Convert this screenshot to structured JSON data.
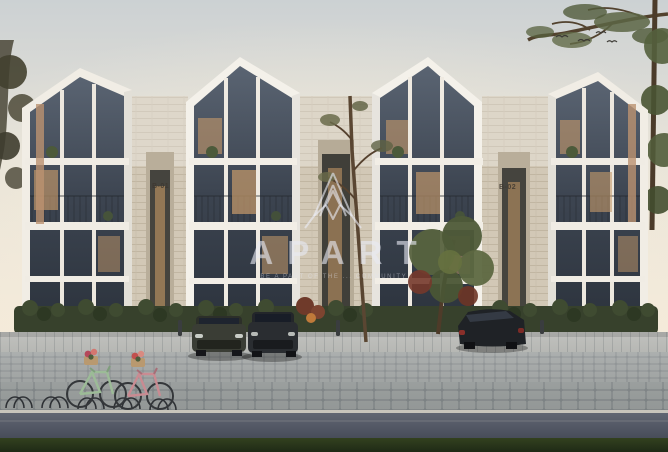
{
  "image": {
    "kind": "architectural-exterior-render",
    "description": "Dusk rendering of a modern residential complex: four white gabled glass-fronted townhouse units joined by stone-clad sections, hedges and trees in front, cobblestone plaza with parked SUVs and two bicycles with flower baskets, pine branch overhanging the sky at top right, semi-transparent APART watermark centered."
  },
  "watermark": {
    "brand": "APART",
    "tagline": "BE A PART OF THE ... COMMUNITY",
    "logo": "apart-pyramid-lattice-logo",
    "color": "rgba(230,233,243,0.55)"
  },
  "building": {
    "unit_labels": [
      "B-01",
      "B-02"
    ],
    "floors": 3,
    "gabled_units": 4
  },
  "objects": {
    "vehicles": [
      "dark olive SUV (front view)",
      "dark gray SUV (front view)",
      "dark SUV (rear three-quarter view)"
    ],
    "bicycles": [
      "mint green bicycle with flower basket",
      "pink bicycle with flower basket"
    ],
    "other": [
      "bike racks",
      "hedgerow",
      "red flowering shrubs",
      "slender foreground tree",
      "leafy tree",
      "pine branch",
      "flying birds"
    ]
  },
  "colors": {
    "sky_top": "#ccd1d3",
    "sky_glow": "#f4ead9",
    "facade_white": "#f3f0ea",
    "stone": "#d2c8b6",
    "glass_dark": "#323a44",
    "window_warm_light": "#c69a6a",
    "hedge_green": "#3a452f",
    "plaza_gray": "#a9adac",
    "road_gray": "#545a66",
    "grass_dark": "#2c3922"
  }
}
